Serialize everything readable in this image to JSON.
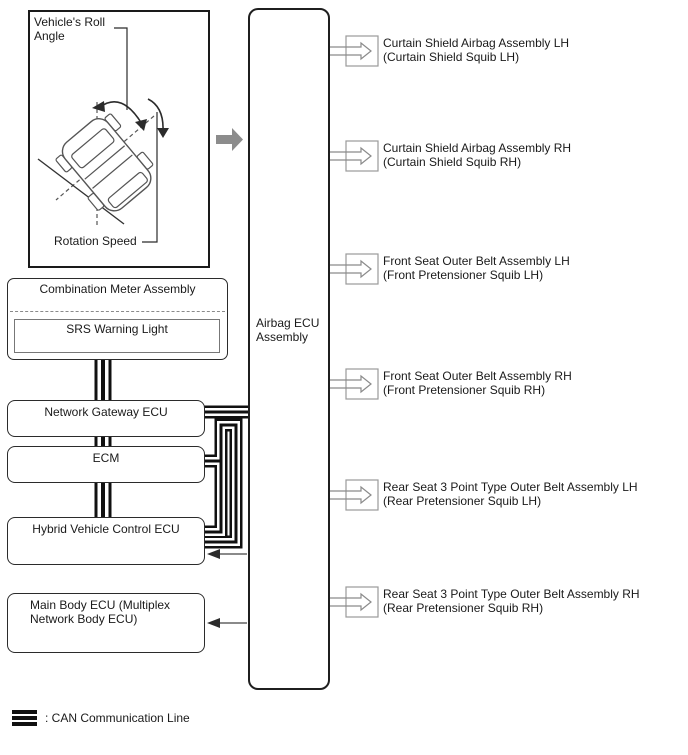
{
  "diagram": {
    "roll_box": {
      "roll_label": "Vehicle's Roll Angle",
      "rotation_label": "Rotation Speed"
    },
    "ecu_label": "Airbag ECU Assembly",
    "meter": {
      "title": "Combination Meter Assembly",
      "warning": "SRS Warning Light"
    },
    "ecus": [
      {
        "label": "Network Gateway ECU"
      },
      {
        "label": "ECM"
      },
      {
        "label": "Hybrid Vehicle Control ECU"
      },
      {
        "label": "Main Body ECU (Multiplex Network Body ECU)"
      }
    ],
    "connectors": [
      {
        "line1": "Curtain Shield Airbag Assembly LH",
        "line2": "(Curtain Shield Squib LH)"
      },
      {
        "line1": "Curtain Shield Airbag Assembly RH",
        "line2": "(Curtain Shield Squib RH)"
      },
      {
        "line1": "Front Seat Outer Belt Assembly LH",
        "line2": "(Front Pretensioner Squib LH)"
      },
      {
        "line1": "Front Seat Outer Belt Assembly RH",
        "line2": "(Front Pretensioner Squib RH)"
      },
      {
        "line1": "Rear Seat 3 Point Type Outer Belt Assembly LH",
        "line2": "(Rear Pretensioner Squib LH)"
      },
      {
        "line1": "Rear Seat 3 Point Type Outer Belt Assembly RH",
        "line2": "(Rear Pretensioner Squib RH)"
      }
    ],
    "legend": ": CAN Communication Line",
    "colors": {
      "line": "#1a1a1a",
      "connector_gray": "#8a8a8a",
      "flow_arrow_gray": "#8c8c8c"
    }
  }
}
